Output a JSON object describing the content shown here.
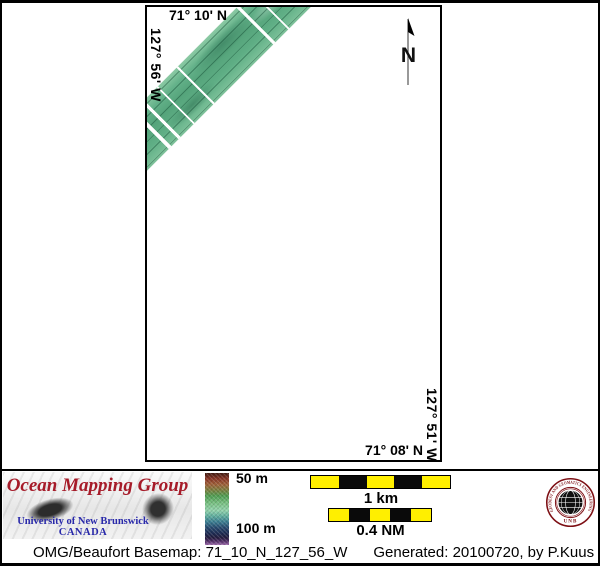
{
  "map": {
    "top_label": "71° 10' N",
    "left_label": "127° 56' W",
    "right_label": "127° 51' W",
    "bottom_label": "71° 08' N",
    "north_label": "N"
  },
  "colorbar": {
    "top_label": "50 m",
    "bottom_label": "100 m"
  },
  "scalebars": {
    "km_label": "1 km",
    "nm_label": "0.4 NM"
  },
  "logo": {
    "title": "Ocean Mapping Group",
    "university": "University of New Brunswick",
    "country": "CANADA"
  },
  "seal": {
    "ring_text": "GEODESY AND GEOMATICS ENGINEERING",
    "unb": "UNB"
  },
  "footer": {
    "basemap": "OMG/Beaufort Basemap: 71_10_N_127_56_W",
    "generated": "Generated: 20100720, by P.Kuus"
  },
  "colors": {
    "logo_red": "#a61b29",
    "logo_blue": "#2929aa",
    "seal_red": "#7d0f14",
    "scale_yellow": "#ffef00",
    "swath_green": "#5fae85"
  }
}
